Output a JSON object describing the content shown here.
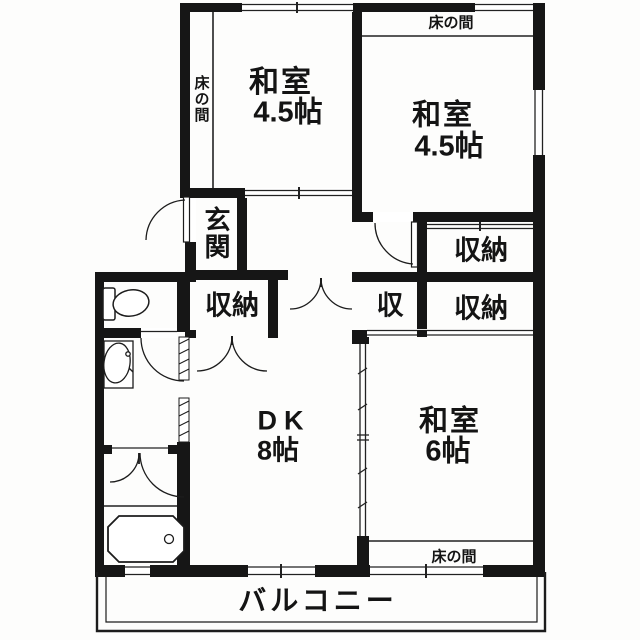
{
  "floorplan": {
    "colors": {
      "line": "#161616",
      "paper": "#ffffff"
    },
    "rooms": {
      "washitsu_nw": {
        "name": "和室",
        "size": "4.5帖",
        "tokonoma_label": "床の間"
      },
      "washitsu_ne": {
        "name": "和室",
        "size": "4.5帖",
        "tokonoma_label": "床の間"
      },
      "washitsu_se": {
        "name": "和室",
        "size": "6帖",
        "tokonoma_label": "床の間"
      },
      "dining_kitchen": {
        "name": "DK",
        "size": "8帖"
      },
      "entrance": {
        "label": "玄関"
      },
      "balcony": {
        "label": "バルコニー"
      }
    },
    "closets": {
      "hall_closet": {
        "label": "収納"
      },
      "ne_closet": {
        "label": "収納"
      },
      "mid_closet": {
        "label": "収"
      },
      "se_closet": {
        "label": "収納"
      }
    }
  }
}
